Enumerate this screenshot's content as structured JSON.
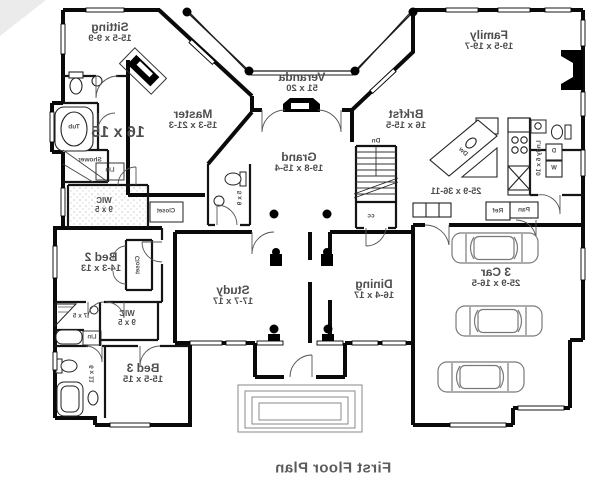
{
  "footer": {
    "title": "First Floor Plan"
  },
  "rooms": {
    "sitting": {
      "name": "Sitting",
      "dims": "15-5 x 9-9"
    },
    "master": {
      "name": "Master",
      "dims": "15-3 x 21-3"
    },
    "veranda": {
      "name": "Veranda",
      "dims": "51 x 20"
    },
    "family": {
      "name": "Family",
      "dims": "19-5 x 19-7"
    },
    "brkfst": {
      "name": "Brkfst",
      "dims": "16 x 15-5"
    },
    "grand": {
      "name": "Grand",
      "dims": "19-8 x 15-4"
    },
    "study": {
      "name": "Study",
      "dims": "17-7 x 17"
    },
    "dining": {
      "name": "Dining",
      "dims": "16-4 x 17"
    },
    "garage": {
      "name": "3 Car",
      "dims": "25-9 x 16-5"
    },
    "bed2": {
      "name": "Bed 2",
      "dims": "14-3 x 13"
    },
    "bed3": {
      "name": "Bed 3",
      "dims": "15-5 x 15"
    },
    "wic_master": {
      "name": "WIC",
      "dims": "9 x 5"
    },
    "wic_bed3": {
      "name": "WIC",
      "dims": "9 x 5"
    },
    "laundry": {
      "name": "Lndy",
      "dims": "6 x 10"
    }
  },
  "dims": {
    "kitchen_area": "25-9 x 36-11",
    "master_bath": "16 x 15",
    "powder_bath": "5 x 9",
    "hall_bath": "7 x 5",
    "bed3_bath": "6 x 11"
  },
  "fixtures": {
    "tub": "Tub",
    "shower": "Shower",
    "linen1": "Lin",
    "linen2": "Lin",
    "closet_hall": "Closet",
    "closet_bed2": "Closet",
    "stairs_down": "Dn",
    "coat_closet": "cc",
    "dishwasher": "Dw",
    "refrigerator": "Ref",
    "pantry": "Pan",
    "washer": "W",
    "dryer": "D"
  }
}
